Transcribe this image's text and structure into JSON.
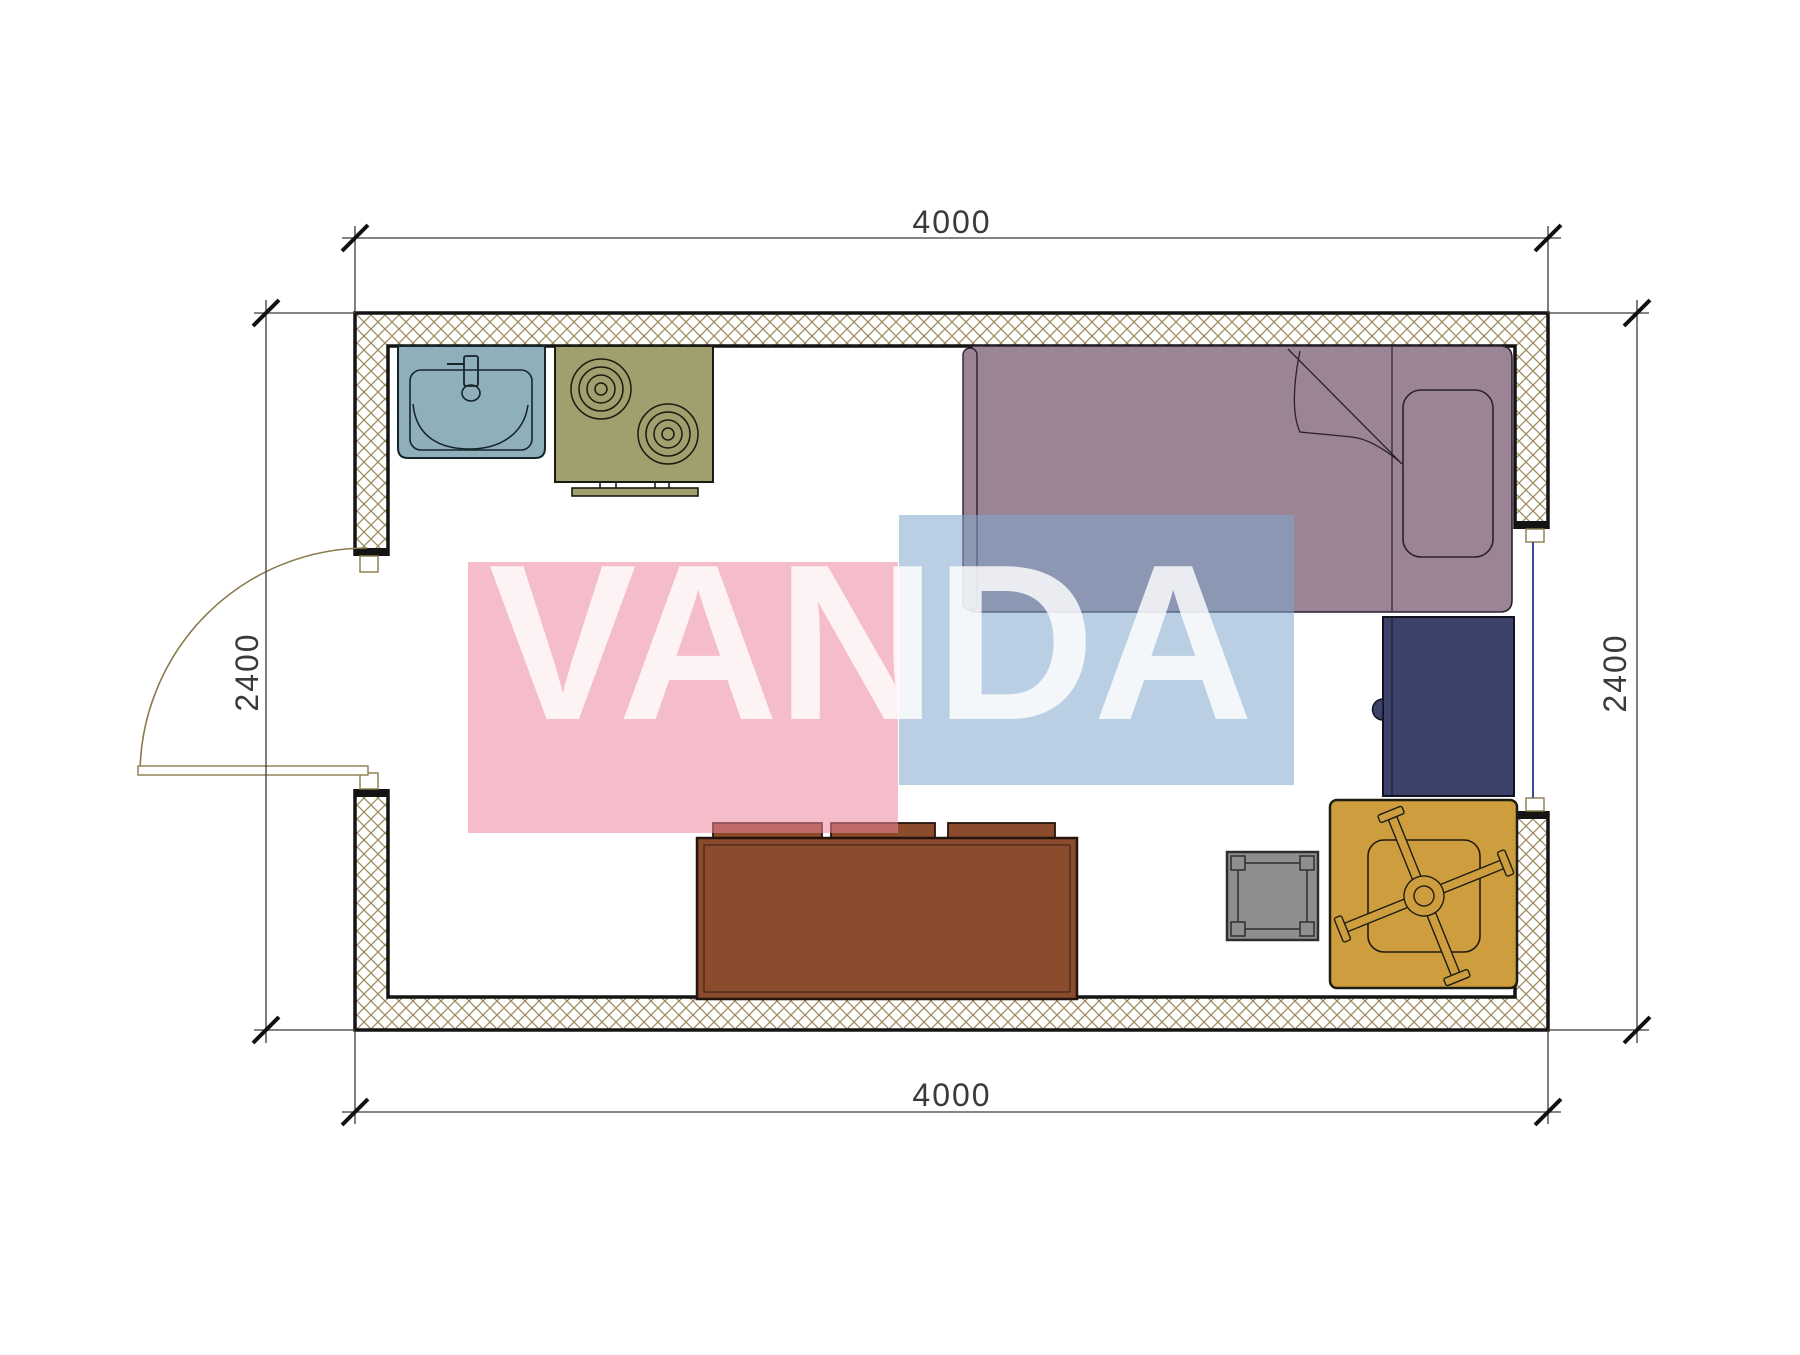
{
  "drawing_title": "studio-room-floor-plan",
  "dims": {
    "top": "4000",
    "bottom": "4000",
    "left": "2400",
    "right": "2400"
  },
  "watermark": {
    "text": "VANDA"
  },
  "colors": {
    "wall-line": "#141414",
    "hatch": "#9b8758",
    "dim": "#3a3a3a",
    "door": "#8a7a4a",
    "window-blue": "#3a4aa0",
    "sink": "#8FAFBA",
    "stove": "#A0A06E",
    "bed": "#9A8495",
    "desk": "#3C4269",
    "sofa": "#8B4B2D",
    "stool": "#8E8E8E",
    "chair": "#CE9D3E",
    "wm-pink": "#EC879D",
    "wm-blue": "#82A8CE",
    "wm-text": "#FFFFFF"
  },
  "elements": {
    "room": "4000 x 2400 studio with door on left wall and window on right wall",
    "furniture": [
      "kitchen-sink",
      "stove",
      "single-bed",
      "pillow",
      "desk",
      "sofa",
      "side-stool",
      "swivel-armchair"
    ]
  }
}
